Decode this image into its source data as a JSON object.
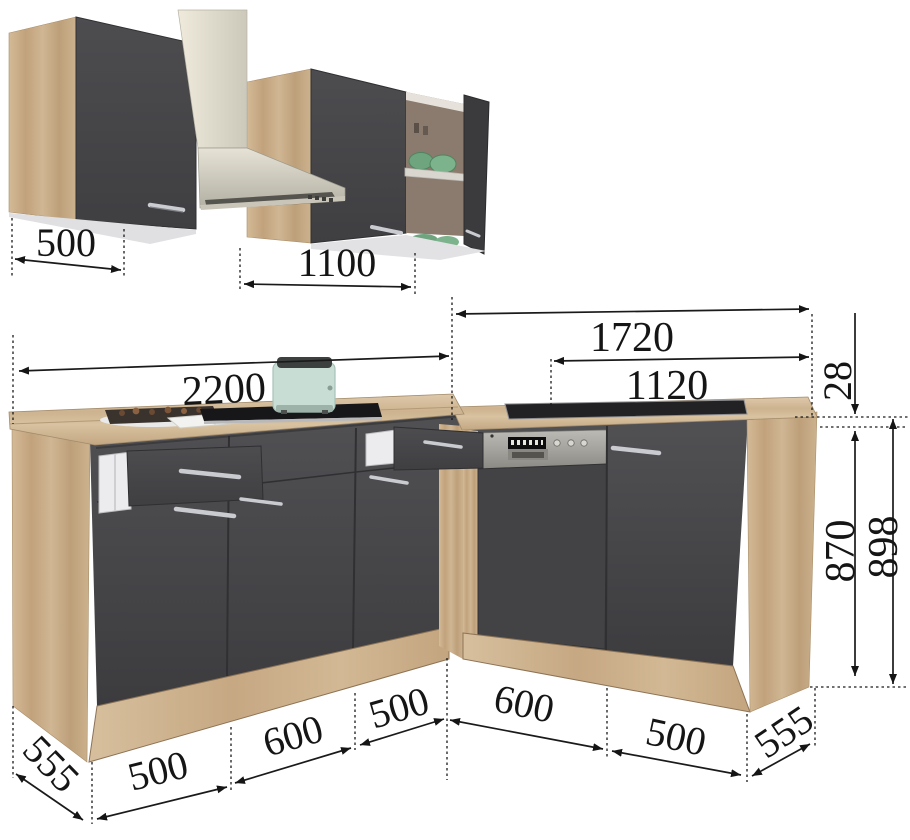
{
  "dimensions": {
    "wall_cabinet": "500",
    "upper_run": "1100",
    "left_counter": "2200",
    "right_total": "1720",
    "right_counter": "1120",
    "counter_thickness": "28",
    "carcass_height": "870",
    "total_height": "898",
    "left_depth": "555",
    "right_depth": "555",
    "left_segments": [
      "500",
      "600",
      "500"
    ],
    "right_segments": [
      "600",
      "500"
    ]
  },
  "colors": {
    "wood_light": "#d3bb98",
    "wood_dark": "#c2a47e",
    "cabinet_front": "#47474a",
    "stainless": "#c9c6ba",
    "bowl_green": "#6fa57e",
    "toaster_mint": "#c8ded5",
    "dimension_ink": "#151515",
    "background": "#ffffff"
  }
}
